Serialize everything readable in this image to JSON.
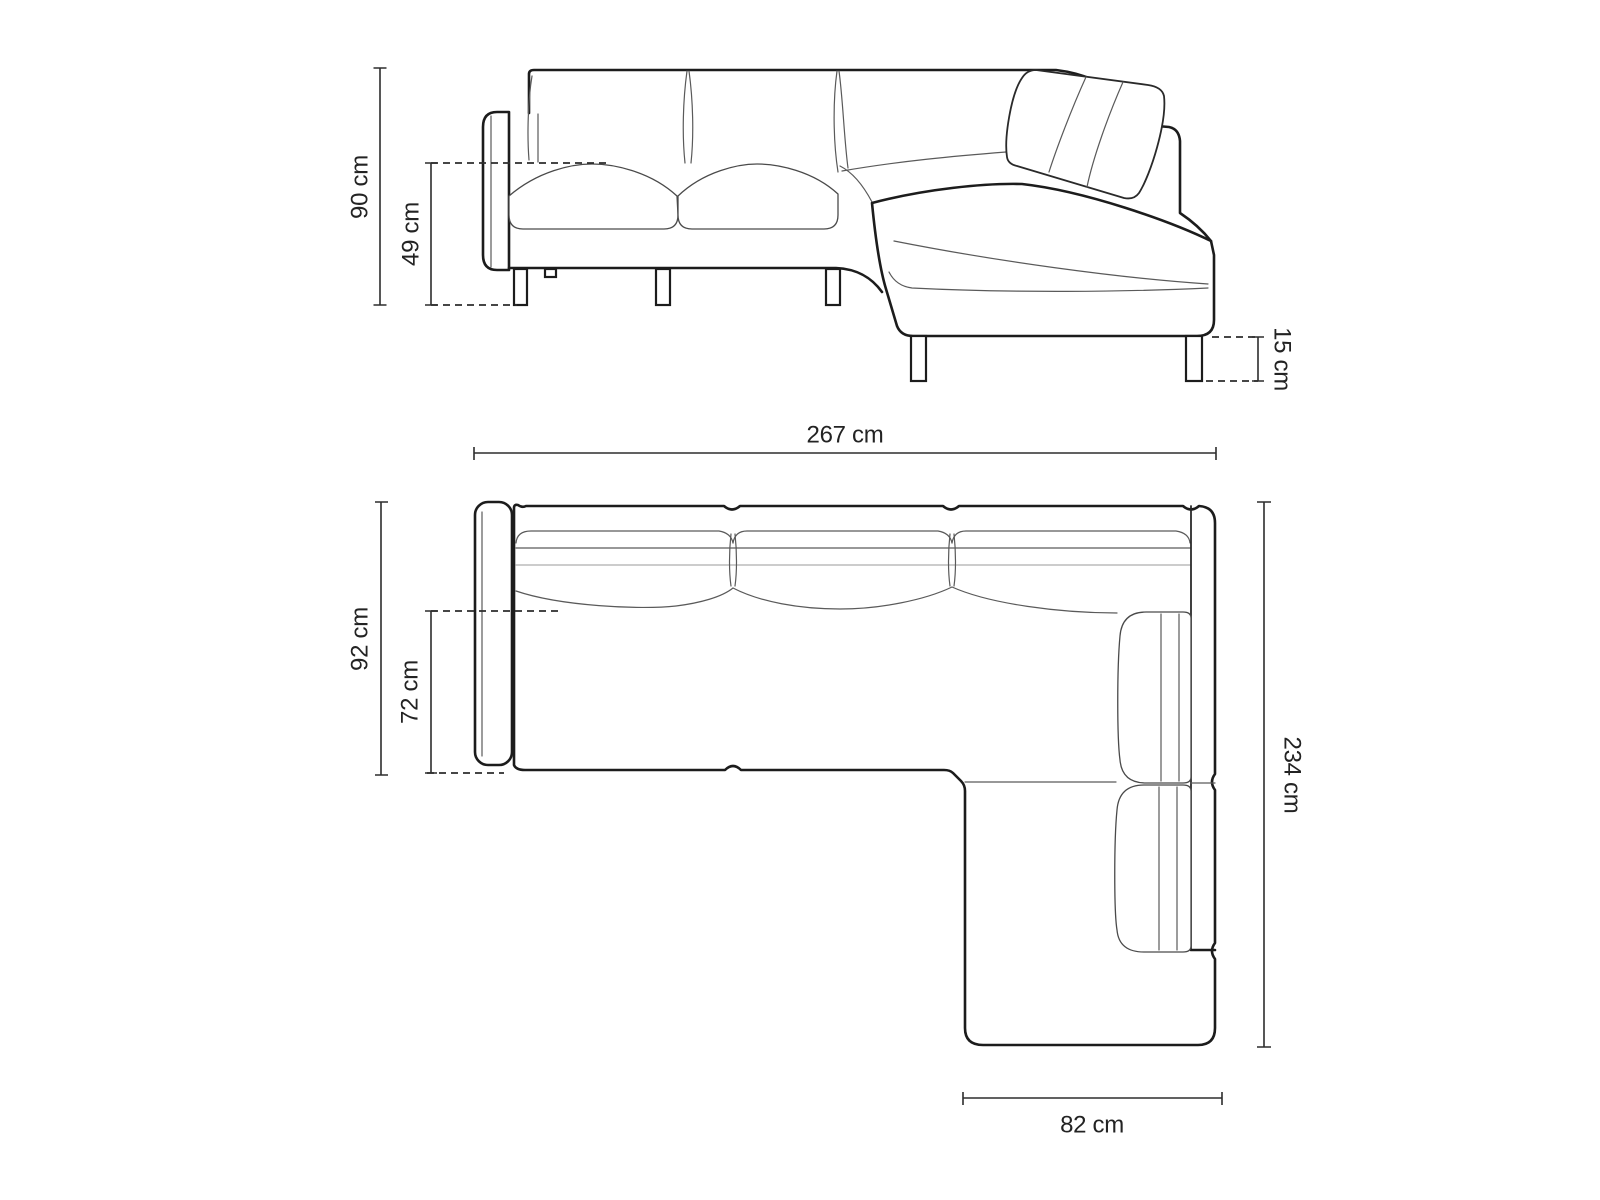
{
  "diagram": {
    "title": "Corner sofa technical dimension drawing",
    "subject": "corner-sofa-with-chaise",
    "unit": "cm",
    "colors": {
      "background": "#ffffff",
      "outline": "#1c1c1c",
      "detail_line": "#5a5a5a",
      "light_line": "#9a9a9a",
      "dimension_line": "#2d2d2d",
      "label_text": "#232323"
    },
    "views": {
      "front": {
        "name": "front elevation",
        "dimensions": {
          "total_height": {
            "label": "90 cm",
            "value": 90,
            "unit": "cm"
          },
          "seat_height": {
            "label": "49 cm",
            "value": 49,
            "unit": "cm"
          },
          "leg_height": {
            "label": "15 cm",
            "value": 15,
            "unit": "cm"
          }
        }
      },
      "top": {
        "name": "top plan",
        "dimensions": {
          "total_width": {
            "label": "267 cm",
            "value": 267,
            "unit": "cm"
          },
          "side_depth": {
            "label": "92 cm",
            "value": 92,
            "unit": "cm"
          },
          "seat_depth": {
            "label": "72 cm",
            "value": 72,
            "unit": "cm"
          },
          "total_depth": {
            "label": "234 cm",
            "value": 234,
            "unit": "cm"
          },
          "chaise_width": {
            "label": "82 cm",
            "value": 82,
            "unit": "cm"
          }
        }
      }
    }
  }
}
